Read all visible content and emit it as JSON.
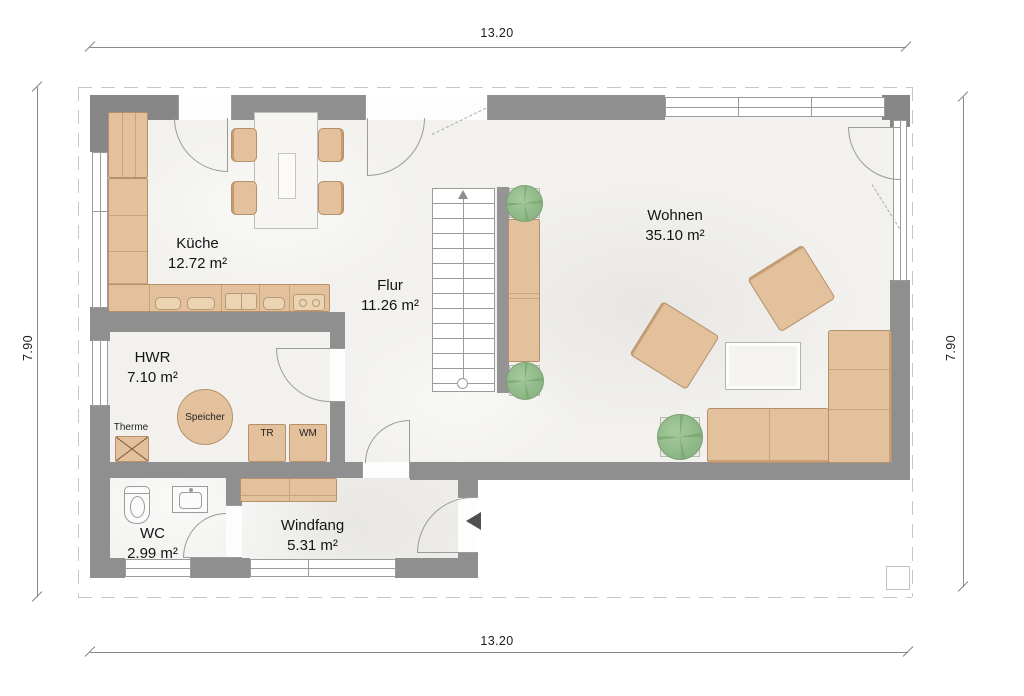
{
  "dimensions": {
    "width_top": "13.20",
    "width_bottom": "13.20",
    "height_left": "7.90",
    "height_right": "7.90"
  },
  "rooms": [
    {
      "name": "Küche",
      "area": "12.72 m²"
    },
    {
      "name": "Flur",
      "area": "11.26 m²"
    },
    {
      "name": "Wohnen",
      "area": "35.10 m²"
    },
    {
      "name": "HWR",
      "area": "7.10 m²"
    },
    {
      "name": "WC",
      "area": "2.99 m²"
    },
    {
      "name": "Windfang",
      "area": "5.31 m²"
    }
  ],
  "equipment": {
    "therme": "Therme",
    "speicher": "Speicher",
    "tumble_dryer": "TR",
    "washing_machine": "WM"
  },
  "icons": {
    "entrance_arrow": "entrance-direction-arrow",
    "stair_arrow": "stair-up-arrow"
  },
  "colors": {
    "wall": "#8f8f8f",
    "floor": "#f2f1ee",
    "furniture": "#e3c19c",
    "furniture_border": "#b5906a",
    "plant": "#8db786",
    "table": "#f5f3f0",
    "roof_outline": "#c6c6c6",
    "dimension_line": "#8a8a8a",
    "text": "#1a1a1a"
  }
}
